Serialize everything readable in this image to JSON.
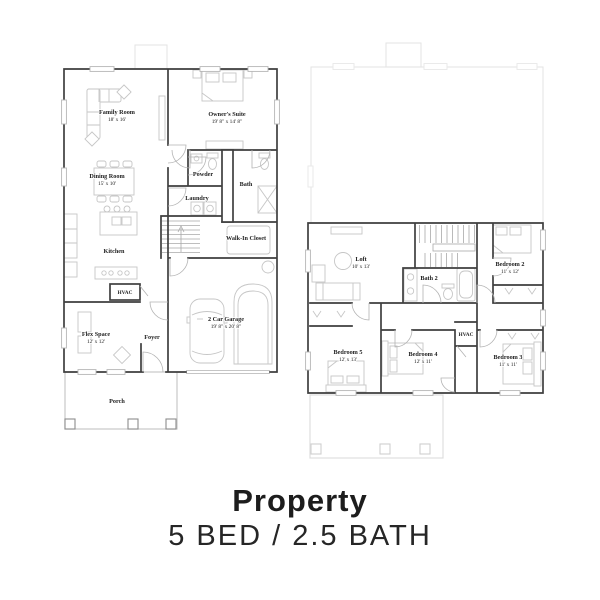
{
  "footer": {
    "title": "Property",
    "subtitle": "5 BED / 2.5 BATH"
  },
  "colors": {
    "wall": "#3f3f3f",
    "fixture": "#c6c6c6",
    "door": "#b3b3b3",
    "faint": "#e5e5e5",
    "ink": "#232323",
    "title": "#1d1d1d"
  },
  "floor1": {
    "family_room": {
      "name": "Family Room",
      "dims": "18' x 16'"
    },
    "dining_room": {
      "name": "Dining Room",
      "dims": "15' x 10'"
    },
    "kitchen": {
      "name": "Kitchen"
    },
    "owners_suite": {
      "name": "Owner's Suite",
      "dims": "19' 8\" x 14' 8\""
    },
    "powder": {
      "name": "Powder"
    },
    "laundry": {
      "name": "Laundry"
    },
    "bath": {
      "name": "Bath"
    },
    "walk_in_closet": {
      "name": "Walk-In Closet"
    },
    "hvac": {
      "name": "HVAC"
    },
    "flex_space": {
      "name": "Flex Space",
      "dims": "12' x 12'"
    },
    "foyer": {
      "name": "Foyer"
    },
    "garage": {
      "name": "2 Car Garage",
      "dims": "19' 8\" x 20' 8\""
    },
    "porch": {
      "name": "Porch"
    }
  },
  "floor2": {
    "loft": {
      "name": "Loft",
      "dims": "10' x 13'"
    },
    "bath2": {
      "name": "Bath 2"
    },
    "bedroom2": {
      "name": "Bedroom 2",
      "dims": "11' x 12'"
    },
    "hvac": {
      "name": "HVAC"
    },
    "bedroom5": {
      "name": "Bedroom 5",
      "dims": "12' x 13'"
    },
    "bedroom4": {
      "name": "Bedroom 4",
      "dims": "12' x 11'"
    },
    "bedroom3": {
      "name": "Bedroom 3",
      "dims": "11' x 11'"
    }
  }
}
